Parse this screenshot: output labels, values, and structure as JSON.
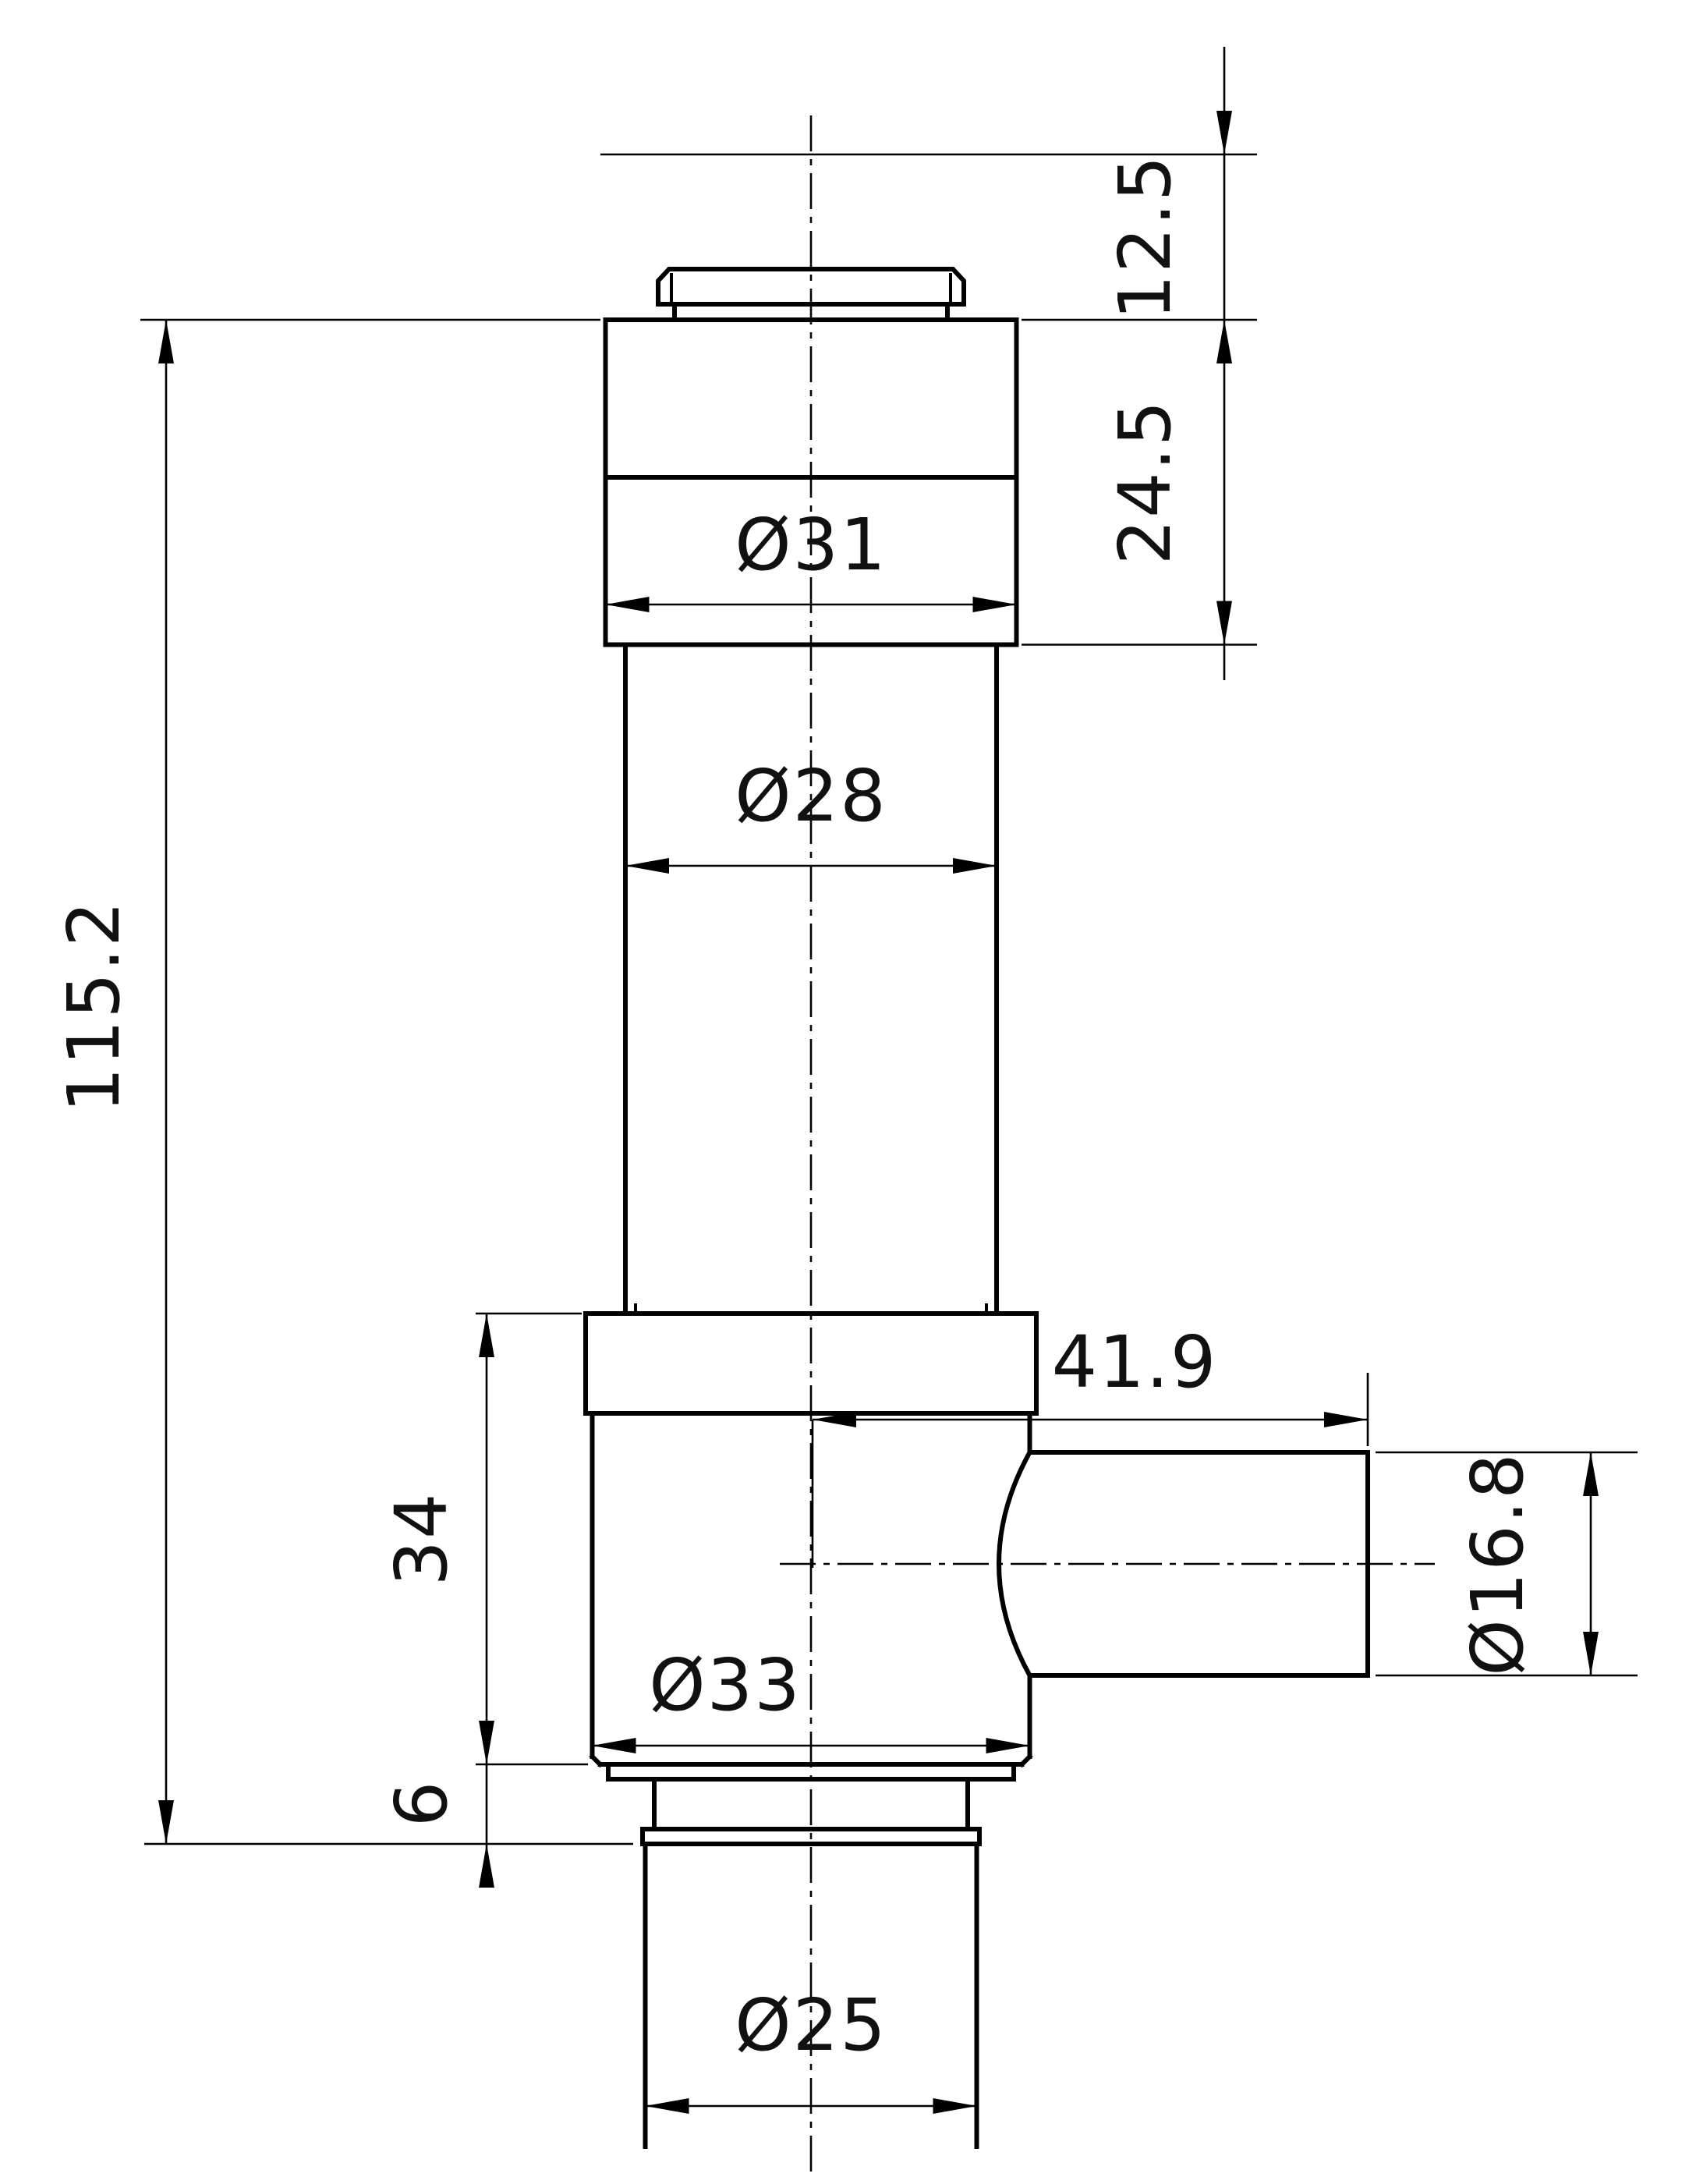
{
  "drawing": {
    "kind": "technical-dimension-drawing",
    "view": "front-section-elevation-of-turned-valve-part",
    "colors": {
      "line": "#000000",
      "background": "#ffffff"
    },
    "dimensions": {
      "top_offset": "12.5",
      "head_height": "24.5",
      "head_diameter": "Ø31",
      "stem_diameter": "Ø28",
      "overall_height": "115.2",
      "port_length": "41.9",
      "body_height": "34",
      "body_diameter": "Ø33",
      "port_diameter": "Ø16.8",
      "flange_height": "6",
      "base_diameter": "Ø25"
    }
  }
}
